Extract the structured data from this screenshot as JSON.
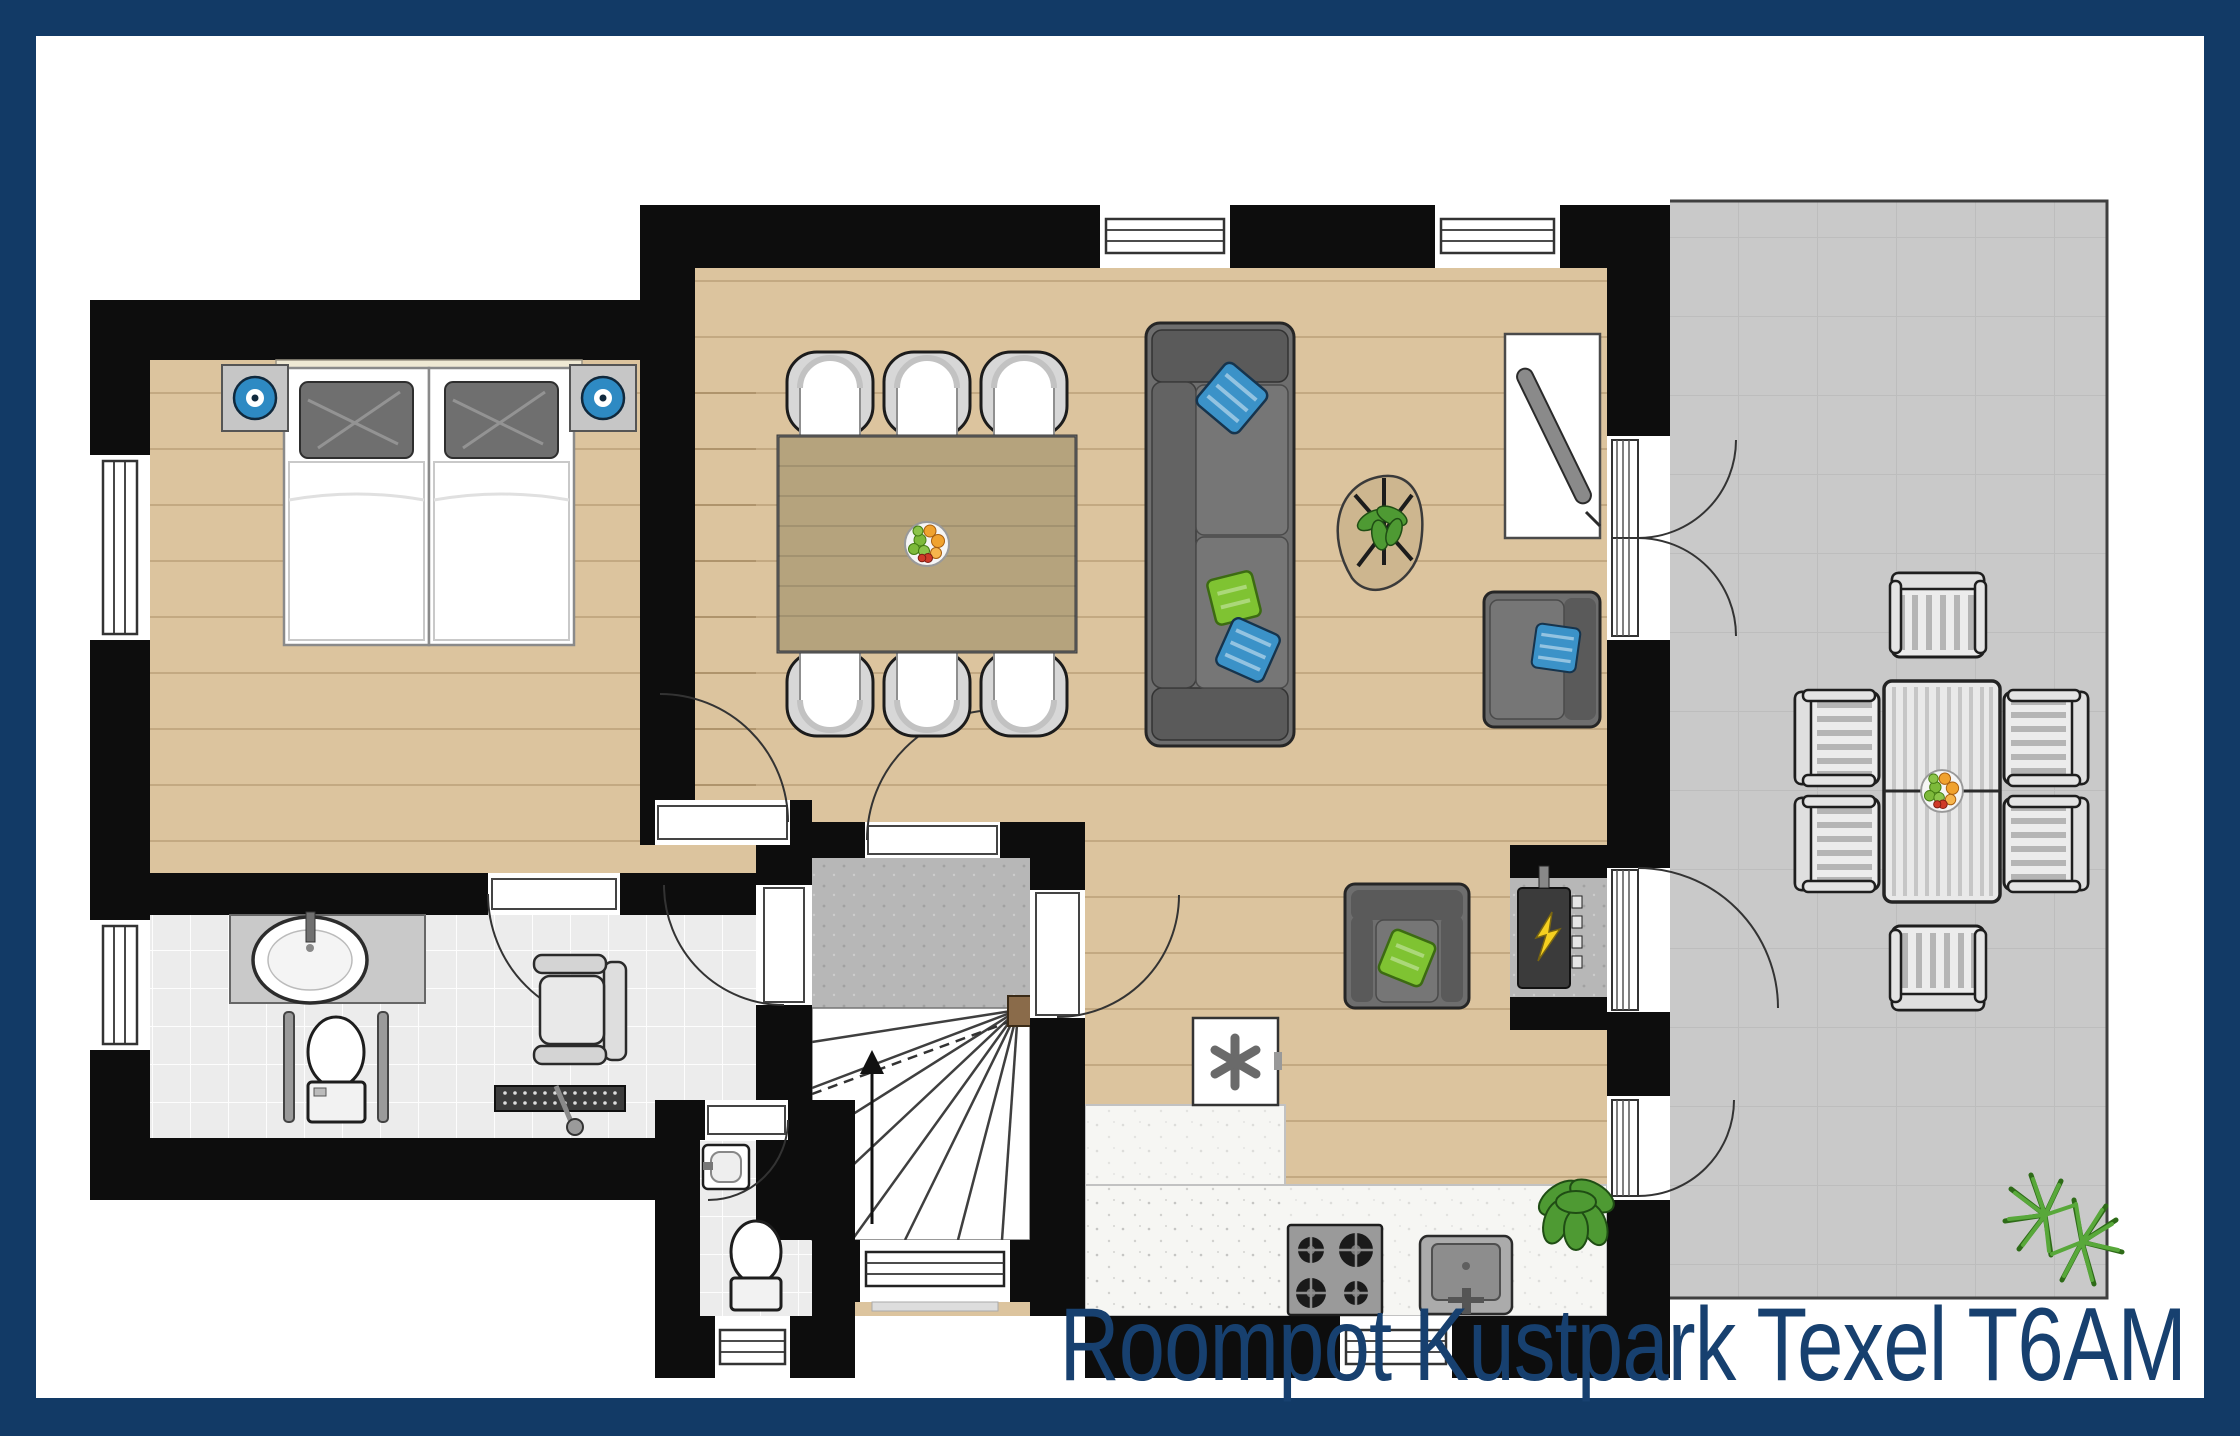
{
  "title": "Roompot Kustpark Texel T6AM",
  "palette": {
    "navy": "#123A66",
    "titleink": "#17406F",
    "wall": "#0D0D0D",
    "wood": "#DCC49E",
    "tablewood": "#B5A37D",
    "terrace": "#C9C9C9",
    "tile": "#ECECEC",
    "concrete": "#B7B7B7",
    "counter": "#F6F6F3",
    "sofa": "#6E6E6E",
    "sofadark": "#5A5A5A",
    "cushion": "#767676",
    "pillowblue": "#3B92C8",
    "pillowgreen": "#7FC332",
    "lampblue": "#2E8AC3",
    "plant": "#4E9A33",
    "grass": "#58A83A",
    "bolt": "#F5D020",
    "chairlight": "#E9E9E9",
    "white": "#FFFFFF"
  },
  "legend": [
    "bedroom-double-beds",
    "nightstand-lamps",
    "bathroom-sink",
    "toilet-with-grab-bars",
    "shower-seat",
    "shower-drain",
    "staircase-up",
    "entrance-door",
    "wc-toilet",
    "wc-corner-sink",
    "washing-machine",
    "kitchen-counter",
    "gas-stove",
    "kitchen-sink",
    "meter-cupboard",
    "dining-table-six-chairs",
    "fruit-bowl",
    "sofa",
    "coffee-table-with-plant",
    "tv-cabinet",
    "armchair-blue-pillow",
    "armchair-green-pillow",
    "indoor-plant",
    "terrace",
    "outdoor-dining-set",
    "outdoor-plant"
  ]
}
